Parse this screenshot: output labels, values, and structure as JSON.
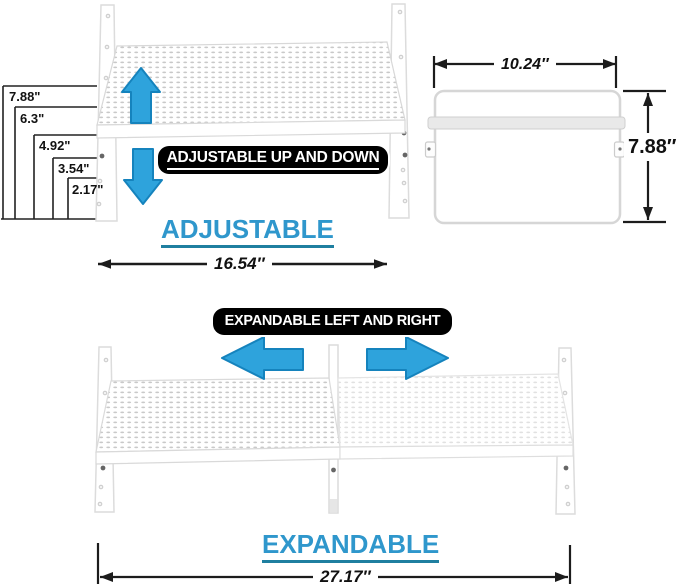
{
  "colors": {
    "arrow_fill": "#2ea3dc",
    "arrow_stroke": "#1583bd",
    "heading_text": "#2f97cc",
    "heading_underline": "#1f7fa0",
    "banner_bg": "#000000",
    "banner_text": "#ffffff",
    "dimension_line": "#1c1c1c",
    "shelf_outline": "#d8d8d8"
  },
  "adjustable_section": {
    "height_labels": [
      "7.88\"",
      "6.3\"",
      "4.92\"",
      "3.54\"",
      "2.17\""
    ],
    "banner_label": "ADJUSTABLE UP AND DOWN",
    "heading": "ADJUSTABLE",
    "width_label": "16.54″",
    "side_view": {
      "width_label": "10.24″",
      "height_label": "7.88″"
    }
  },
  "expandable_section": {
    "banner_label": "EXPANDABLE LEFT AND RIGHT",
    "heading": "EXPANDABLE",
    "width_label": "27.17″"
  },
  "icons": {
    "up_arrow": "up-arrow-icon",
    "down_arrow": "down-arrow-icon",
    "left_arrow": "left-arrow-icon",
    "right_arrow": "right-arrow-icon"
  }
}
